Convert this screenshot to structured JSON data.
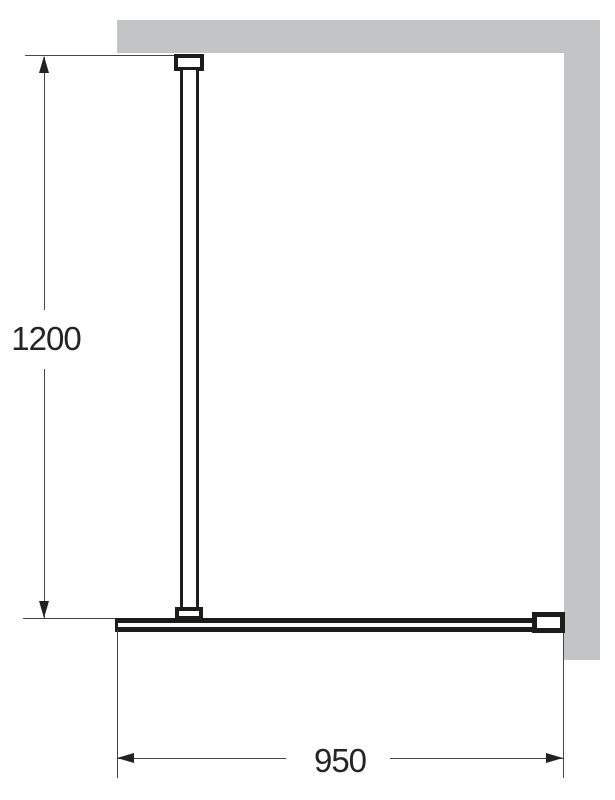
{
  "diagram": {
    "type": "technical-drawing",
    "subject": "walk-in shower glass screen with ceiling support bar, wall shown in grey",
    "dimensions": {
      "height": {
        "label": "1200",
        "orientation": "vertical"
      },
      "width": {
        "label": "950",
        "orientation": "horizontal"
      }
    },
    "parts": [
      {
        "name": "wall-top"
      },
      {
        "name": "wall-right"
      },
      {
        "name": "ceiling-bracket"
      },
      {
        "name": "support-bar"
      },
      {
        "name": "bar-foot-bracket"
      },
      {
        "name": "glass-panel"
      },
      {
        "name": "wall-mount-bracket"
      }
    ],
    "colors": {
      "wall_fill": "#c2c4c6",
      "component_line": "#1c1c1a",
      "dimension_line": "#454547",
      "arrow": "#222220",
      "text": "#242422",
      "background": "#ffffff"
    }
  }
}
